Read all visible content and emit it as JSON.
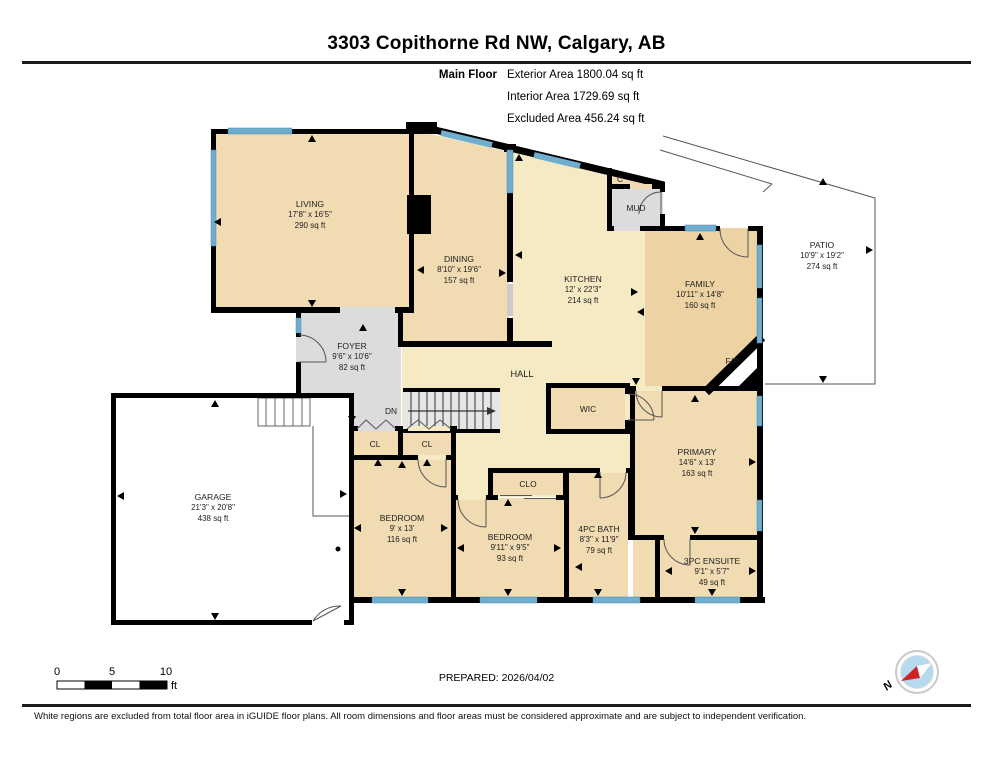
{
  "header": {
    "title": "3303 Copithorne Rd NW, Calgary, AB",
    "floor_label": "Main Floor",
    "area_lines": [
      "Exterior Area 1800.04 sq ft",
      "Interior Area 1729.69 sq ft",
      "Excluded Area 456.24 sq ft"
    ]
  },
  "rooms": [
    {
      "name": "LIVING",
      "dims": "17'8\" x 16'5\"",
      "area": "290 sq ft"
    },
    {
      "name": "DINING",
      "dims": "8'10\" x 19'6\"",
      "area": "157 sq ft"
    },
    {
      "name": "KITCHEN",
      "dims": "12' x 22'3\"",
      "area": "214 sq ft"
    },
    {
      "name": "FAMILY",
      "dims": "10'11\" x 14'8\"",
      "area": "160 sq ft"
    },
    {
      "name": "PATIO",
      "dims": "10'9\" x 19'2\"",
      "area": "274 sq ft"
    },
    {
      "name": "FOYER",
      "dims": "9'6\" x 10'6\"",
      "area": "82 sq ft"
    },
    {
      "name": "GARAGE",
      "dims": "21'3\" x 20'8\"",
      "area": "438 sq ft"
    },
    {
      "name": "BEDROOM",
      "dims": "9' x 13'",
      "area": "116 sq ft"
    },
    {
      "name": "BEDROOM",
      "dims": "9'11\" x 9'5\"",
      "area": "93 sq ft"
    },
    {
      "name": "4PC BATH",
      "dims": "8'3\" x 11'9\"",
      "area": "79 sq ft"
    },
    {
      "name": "PRIMARY",
      "dims": "14'6\" x 13'",
      "area": "163 sq ft"
    },
    {
      "name": "3PC ENSUITE",
      "dims": "9'1\" x 5'7\"",
      "area": "49 sq ft"
    }
  ],
  "labels": {
    "closet_c": "C",
    "mud": "MUD",
    "hall": "HALL",
    "wic": "WIC",
    "stairs_down": "DN",
    "closet_left": "CL",
    "closet_right": "CL",
    "closet_bedroom": "CLO",
    "fireplace": "F/P"
  },
  "footer": {
    "scale_ticks": [
      "0",
      "5",
      "10"
    ],
    "scale_unit": "ft",
    "prepared": "PREPARED: 2026/04/02",
    "compass": "N",
    "disclaimer": "White regions are excluded from total floor area in iGUIDE floor plans. All room dimensions and floor areas must be considered approximate and are subject to independent verification."
  },
  "colors": {
    "wall": "#000000",
    "window": "#6FAECF",
    "room_tan": "#F0DBB2",
    "room_tan_dark": "#EDD3A3",
    "room_pale": "#F6EAC4",
    "room_gray": "#DCDCDC",
    "excluded_white": "#FFFFFF"
  }
}
